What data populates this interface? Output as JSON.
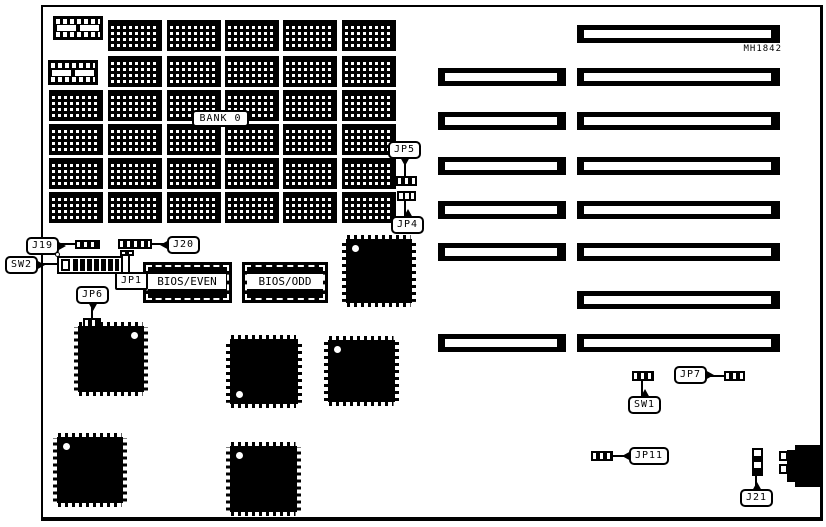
{
  "board": {
    "part_number": "MH1842",
    "memory": {
      "bank_label": "BANK 0"
    },
    "chips": {
      "bios_even": "BIOS/EVEN",
      "bios_odd": "BIOS/ODD"
    },
    "labels": {
      "j19": "J19",
      "j20": "J20",
      "sw2": "SW2",
      "jp1": "JP1",
      "jp6": "JP6",
      "jp5": "JP5",
      "jp4": "JP4",
      "sw1": "SW1",
      "jp7": "JP7",
      "jp11": "JP11",
      "j21": "J21"
    }
  }
}
